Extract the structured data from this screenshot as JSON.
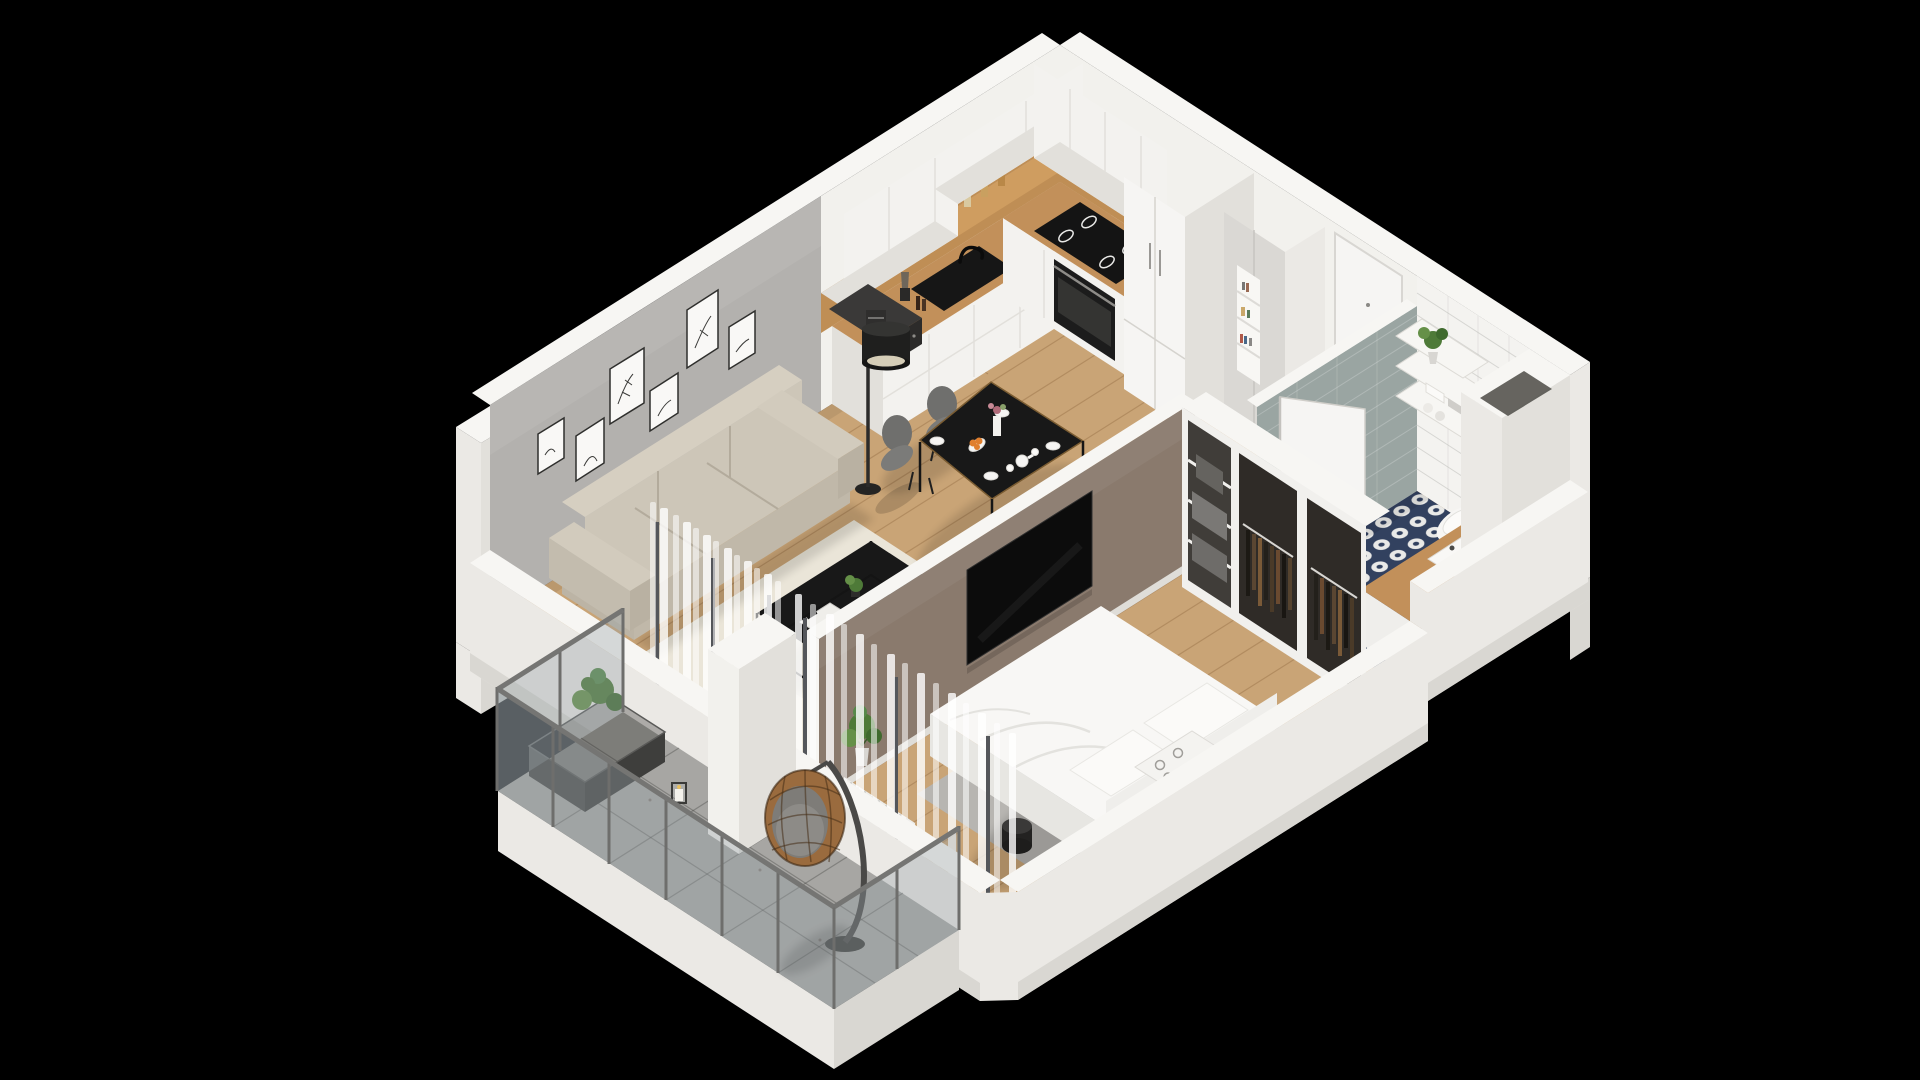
{
  "meta": {
    "type": "isometric-3d-floorplan-render",
    "description": "Cutaway 3D isometric render of a one-bedroom apartment on a black background",
    "background": "#000000"
  },
  "palette": {
    "bg": "#000000",
    "wall_white": "#f2f1ed",
    "wall_shade": "#e2e0db",
    "wall_cap": "#f7f6f3",
    "exterior": "#ebe9e5",
    "plinth": "#d9d7d2",
    "accent_gray": "#b3b1ae",
    "partition_taupe": "#8a7a6d",
    "wood_floor": "#c9a476",
    "wood_counter": "#c2905a",
    "wood_backsplash": "#bf8e55",
    "cabinet_white": "#f3f2ef",
    "door_white": "#f6f5f3",
    "rug_cream": "#eae5d8",
    "rug_gray": "#b7b5b1",
    "sofa_beige": "#cdc6b8",
    "sofa_shade": "#bcb4a5",
    "black_furniture": "#181818",
    "tv_black": "#0c0c0c",
    "chair_gray": "#7b7b79",
    "balcony_floor": "#a7a6a3",
    "railing_gray": "#6e6e6c",
    "glass_tint": "#96a0a5",
    "egg_chair_rattan": "#9a6b3e",
    "bath_navy": "#32415f",
    "bath_dot": "#e9e9e7",
    "shower_tile": "#9aa5a2",
    "bed_white": "#f8f7f5",
    "radiator_white": "#eeedea",
    "plant_green": "#4e7a38",
    "plant_green_light": "#659048",
    "curtain_white": "#ffffff",
    "clothes_dark": "#2f2b27",
    "orange_fruit": "#e07f2e"
  },
  "scene": {
    "rooms": [
      {
        "name": "living-room",
        "items": [
          "beige-sofa",
          "black-coffee-table",
          "cream-rug",
          "floor-lamp",
          "gallery-wall-6-frames",
          "white-curtains"
        ]
      },
      {
        "name": "kitchen",
        "items": [
          "white-upper-cabinets",
          "wood-backsplash",
          "white-base-cabinets",
          "wood-countertop",
          "black-sink-faucet",
          "induction-cooktop",
          "built-in-oven",
          "microwave",
          "coffee-machine",
          "blender",
          "spice-jars",
          "tall-cabinet-column"
        ]
      },
      {
        "name": "dining-area",
        "items": [
          "black-dining-table",
          "four-gray-chairs",
          "plates",
          "teapot",
          "flower-vase",
          "orange-fruit-plate"
        ]
      },
      {
        "name": "entrance-hall",
        "items": [
          "front-door",
          "tall-cabinet-with-book-niche"
        ]
      },
      {
        "name": "bathroom",
        "items": [
          "navy-patterned-tile-floor",
          "white-subway-tile-wall",
          "gray-shower-tile-wall",
          "wall-hung-toilet",
          "cistern-panel",
          "wood-vanity-with-basin",
          "wall-shelves",
          "potted-plant",
          "towels",
          "toilet-paper-holder",
          "open-door",
          "duct-shaft"
        ]
      },
      {
        "name": "bedroom",
        "items": [
          "double-bed-white-duvet",
          "gray-rug",
          "pillows",
          "patterned-pillow",
          "radiator",
          "potted-plant",
          "black-stool",
          "wall-tv-on-partition"
        ]
      },
      {
        "name": "wardrobe",
        "items": [
          "open-closet-hanging-clothes",
          "shelf-unit-gray-boxes"
        ]
      },
      {
        "name": "balcony",
        "items": [
          "glass-railing",
          "gray-tile-floor",
          "hanging-egg-chair",
          "planter-box",
          "candle-lantern",
          "white-stub-wall"
        ]
      }
    ]
  }
}
